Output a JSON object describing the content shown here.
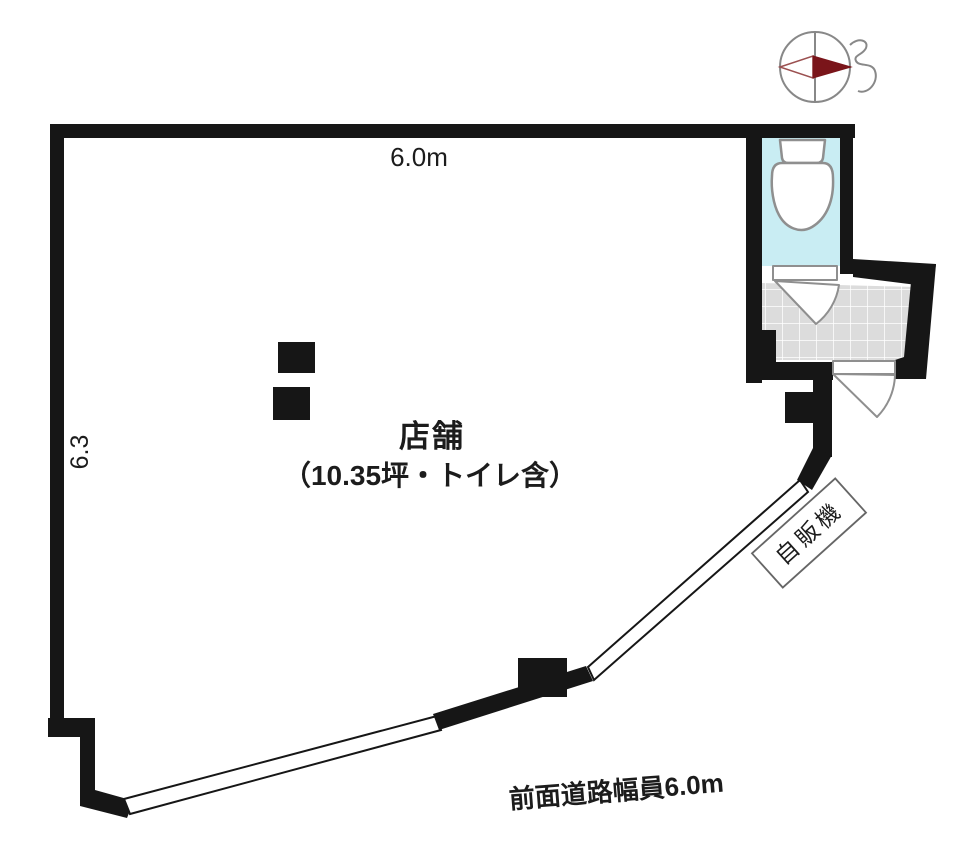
{
  "labels": {
    "top_width": "6.0m",
    "left_depth": "6.3",
    "room_name": "店舗",
    "room_detail": "（10.35坪・トイレ含）",
    "vending_machine": "自販機",
    "front_road": "前面道路幅員6.0m"
  },
  "colors": {
    "wall": "#161616",
    "toilet-floor": "#c9edf3",
    "tile-floor": "#dcdcdc",
    "tile-grid": "#ffffff",
    "fixture-stroke": "#8f8f8f",
    "compass-needle": "#7a151a",
    "compass-line": "#888888",
    "text": "#1c1c1c"
  }
}
